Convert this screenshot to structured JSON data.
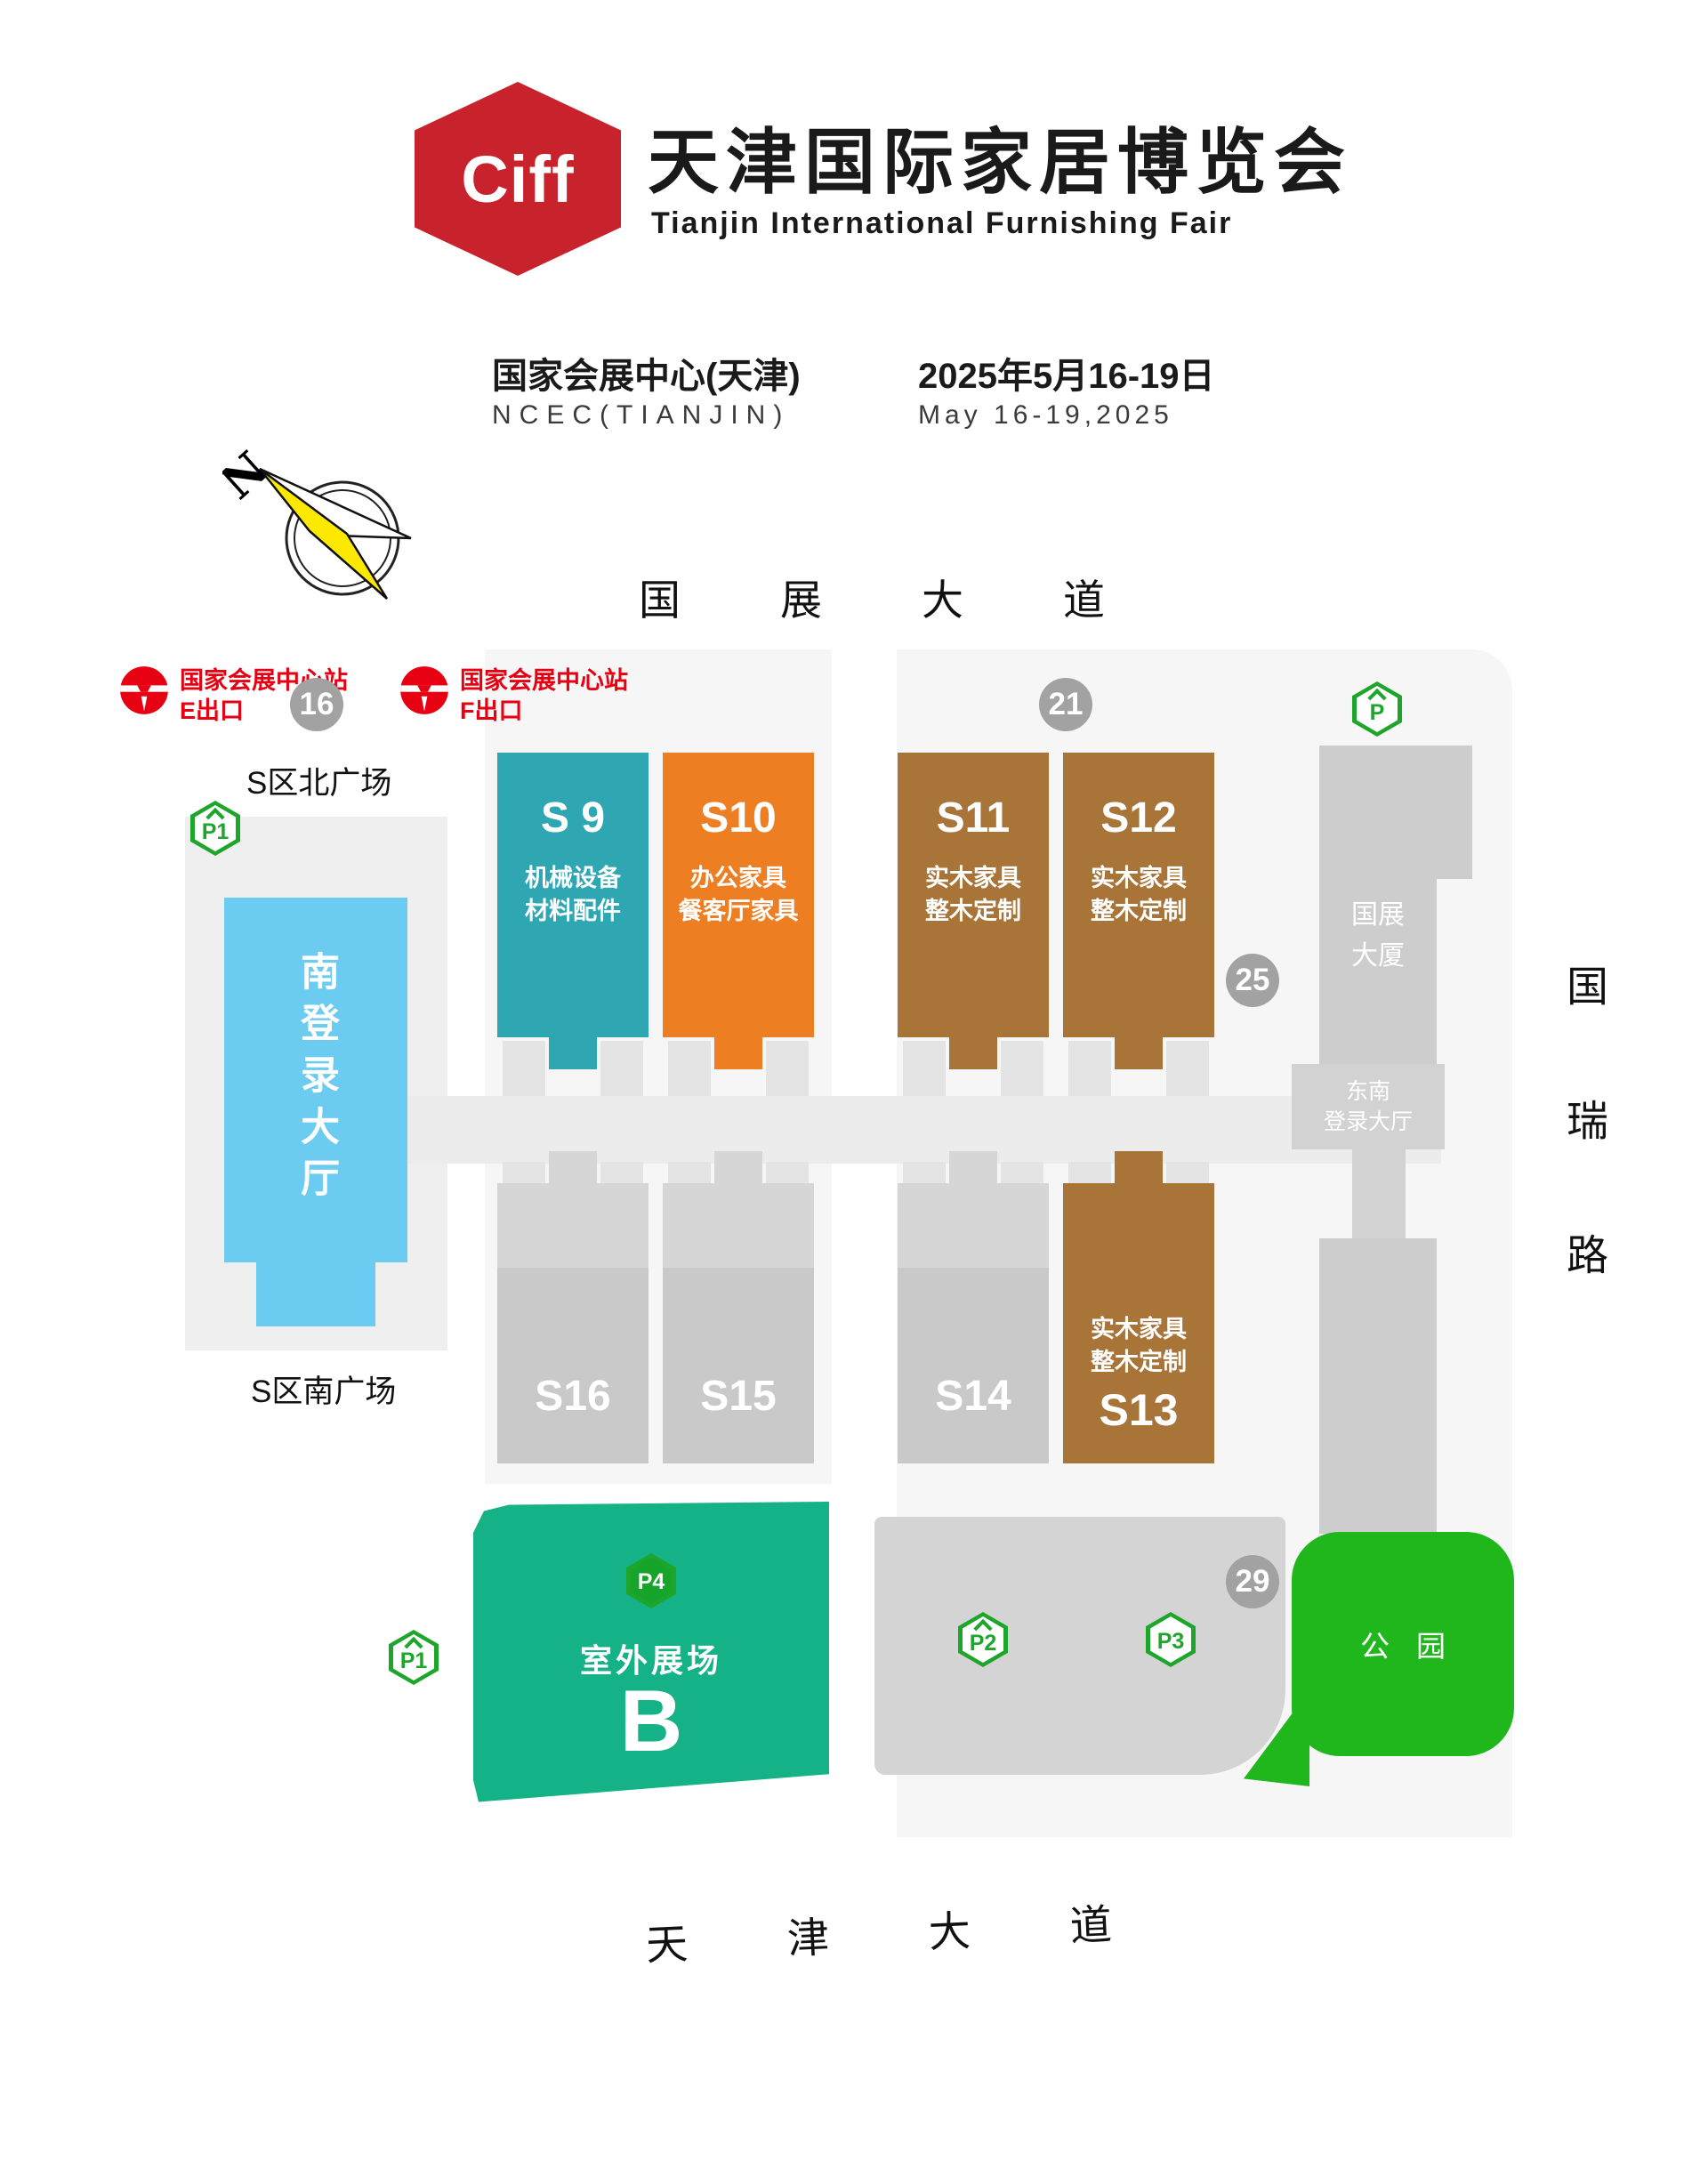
{
  "header": {
    "logo_text": "Ciff",
    "title_cn": "天津国际家居博览会",
    "title_en": "Tianjin International Furnishing Fair",
    "venue_cn": "国家会展中心(天津)",
    "venue_en": "NCEC(TIANJIN)",
    "date_cn": "2025年5月16-19日",
    "date_en": "May 16-19,2025"
  },
  "compass": {
    "north_label": "N"
  },
  "roads": {
    "north": "国展大道",
    "south": "天津大道",
    "east": "国瑞路"
  },
  "metro": {
    "e": {
      "station": "国家会展中心站",
      "exit": "E出口"
    },
    "f": {
      "station": "国家会展中心站",
      "exit": "F出口"
    }
  },
  "gates": {
    "g16": "16",
    "g21": "21",
    "g25": "25",
    "g29": "29"
  },
  "parking": {
    "tower": "P",
    "p1_north": "P1",
    "p1_south": "P1",
    "p2": "P2",
    "p3": "P3",
    "p4": "P4"
  },
  "plazas": {
    "north": "S区北广场",
    "south": "S区南广场"
  },
  "halls": {
    "s9": {
      "id": "S 9",
      "line1": "机械设备",
      "line2": "材料配件",
      "color": "#2fa7b3"
    },
    "s10": {
      "id": "S10",
      "line1": "办公家具",
      "line2": "餐客厅家具",
      "color": "#ee7e22"
    },
    "s11": {
      "id": "S11",
      "line1": "实木家具",
      "line2": "整木定制",
      "color": "#a87438"
    },
    "s12": {
      "id": "S12",
      "line1": "实木家具",
      "line2": "整木定制",
      "color": "#a87438"
    },
    "s13": {
      "id": "S13",
      "line1": "实木家具",
      "line2": "整木定制",
      "color": "#a87438"
    },
    "s14": {
      "id": "S14",
      "color": "#c9c9c9"
    },
    "s15": {
      "id": "S15",
      "color": "#c9c9c9"
    },
    "s16": {
      "id": "S16",
      "color": "#c9c9c9"
    }
  },
  "buildings": {
    "south_lobby": "南登录大厅",
    "tower_line1": "国展",
    "tower_line2": "大厦",
    "se_lobby_line1": "东南",
    "se_lobby_line2": "登录大厅"
  },
  "outdoor": {
    "label": "室外展场",
    "letter": "B",
    "park": "公园"
  },
  "colors": {
    "brand_red": "#c8232c",
    "metro_red": "#e60012",
    "hall_teal": "#2fa7b3",
    "hall_orange": "#ee7e22",
    "hall_brown": "#a87438",
    "hall_gray": "#c9c9c9",
    "lobby_blue": "#6bcbf0",
    "outdoor_green": "#16b287",
    "park_green": "#1fb71b",
    "parking_green": "#1ea52b",
    "gate_gray": "#a2a2a2"
  }
}
